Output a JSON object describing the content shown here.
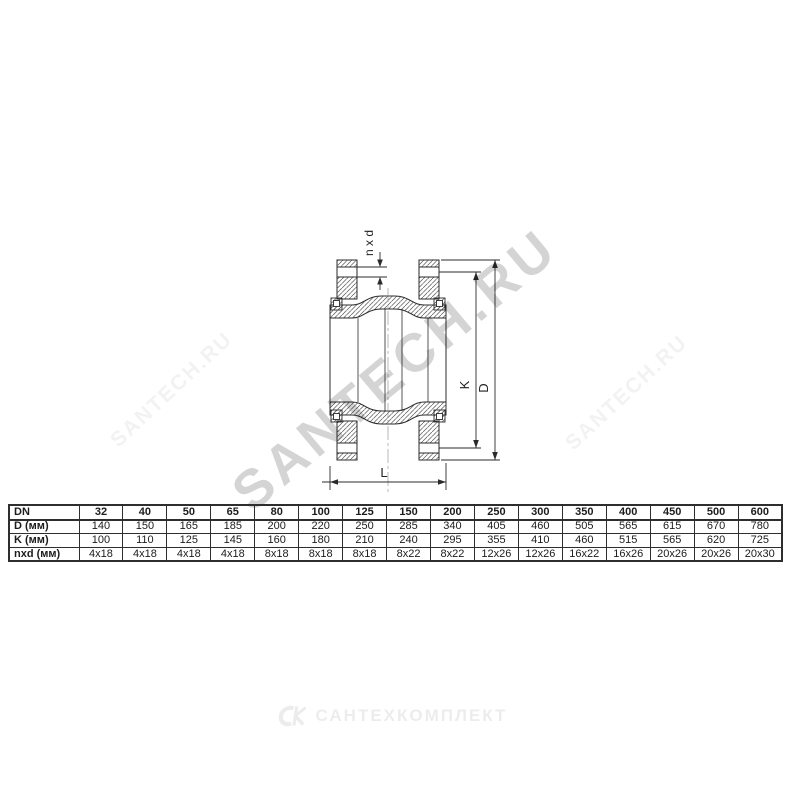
{
  "drawing": {
    "labels": {
      "bolt_pattern": "n x d",
      "bolt_circle": "K",
      "outer_diameter": "D",
      "length": "L"
    }
  },
  "table": {
    "header_row": {
      "label": "DN",
      "values": [
        "32",
        "40",
        "50",
        "65",
        "80",
        "100",
        "125",
        "150",
        "200",
        "250",
        "300",
        "350",
        "400",
        "450",
        "500",
        "600"
      ]
    },
    "rows": [
      {
        "label": "D (мм)",
        "values": [
          "140",
          "150",
          "165",
          "185",
          "200",
          "220",
          "250",
          "285",
          "340",
          "405",
          "460",
          "505",
          "565",
          "615",
          "670",
          "780"
        ]
      },
      {
        "label": "K (мм)",
        "values": [
          "100",
          "110",
          "125",
          "145",
          "160",
          "180",
          "210",
          "240",
          "295",
          "355",
          "410",
          "460",
          "515",
          "565",
          "620",
          "725"
        ]
      },
      {
        "label": "nxd (мм)",
        "values": [
          "4x18",
          "4x18",
          "4x18",
          "4x18",
          "8x18",
          "8x18",
          "8x18",
          "8x22",
          "8x22",
          "12x26",
          "12x26",
          "16x22",
          "16x26",
          "20x26",
          "20x26",
          "20x30"
        ]
      }
    ]
  },
  "watermarks": {
    "center": "SANTECH.RU",
    "left": "SANTECH.RU",
    "right": "SANTECH.RU"
  },
  "footer": {
    "brand": "САНТЕХКОМПЛЕКТ"
  },
  "colors": {
    "line": "#2b2b2b",
    "hatch": "#555555",
    "watermark_center": "rgba(0,0,0,0.17)",
    "watermark_faint": "rgba(0,0,0,0.05)",
    "footer_gray": "rgba(0,0,0,0.075)",
    "background": "#ffffff"
  }
}
